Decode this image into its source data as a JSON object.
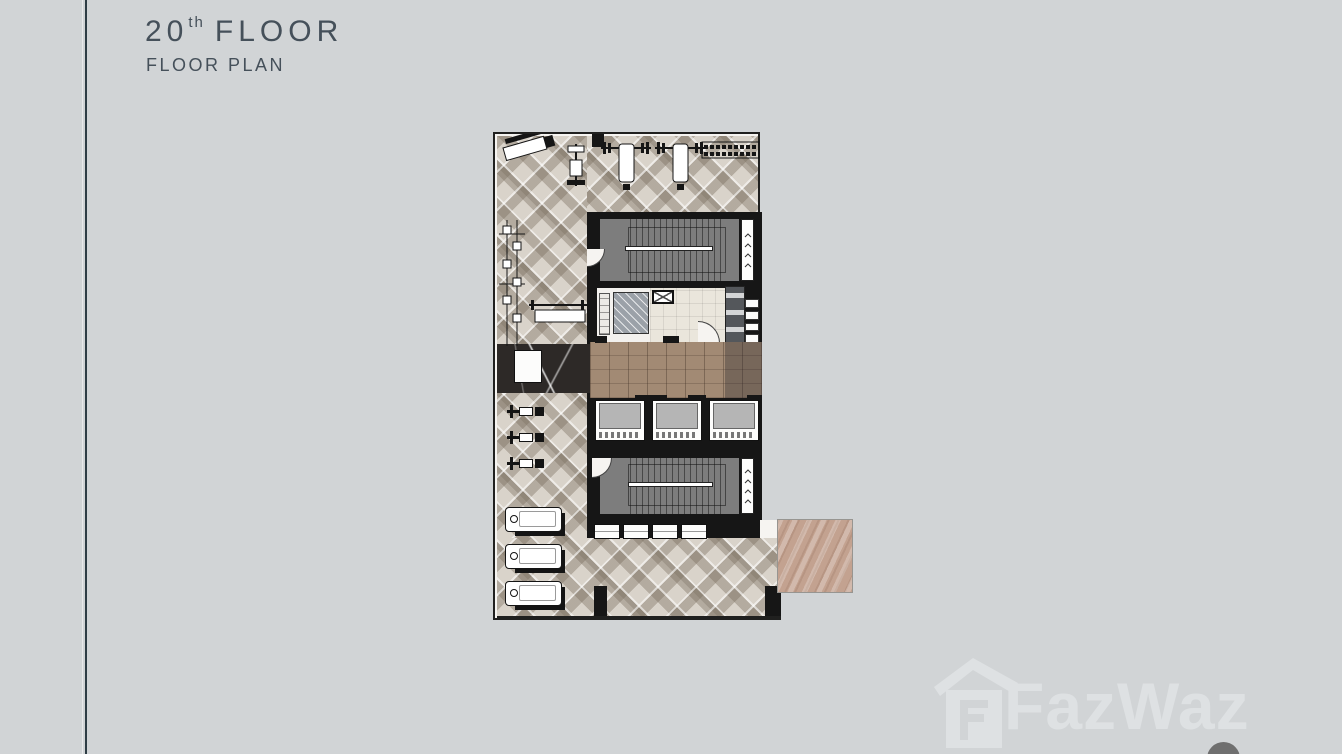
{
  "header": {
    "floor_number": "20",
    "ordinal_suffix": "th",
    "floor_word": "FLOOR",
    "subtitle": "FLOOR PLAN"
  },
  "watermark": {
    "brand": "FazWaz"
  },
  "colors": {
    "background": "#d1d4d6",
    "ink": "#45505a",
    "line": "#2e3d45",
    "wall": "#161616",
    "plan-floor": "#f6f4f1",
    "stair": "#7d7d7d",
    "wood": "#a28a74",
    "deck": "#c3a290",
    "marble": "#2d2927",
    "cream": "#eae6dc",
    "hatch": "#9ba1a8",
    "cab": "#b5b5b5",
    "watermark": "#dee1e3"
  },
  "floorplan": {
    "elevator_count": 3,
    "treadmill_count": 3,
    "spin_bike_count": 3,
    "locker_count": 4,
    "shaft_vent_count": 4,
    "washroom_fixture_count": 4
  }
}
